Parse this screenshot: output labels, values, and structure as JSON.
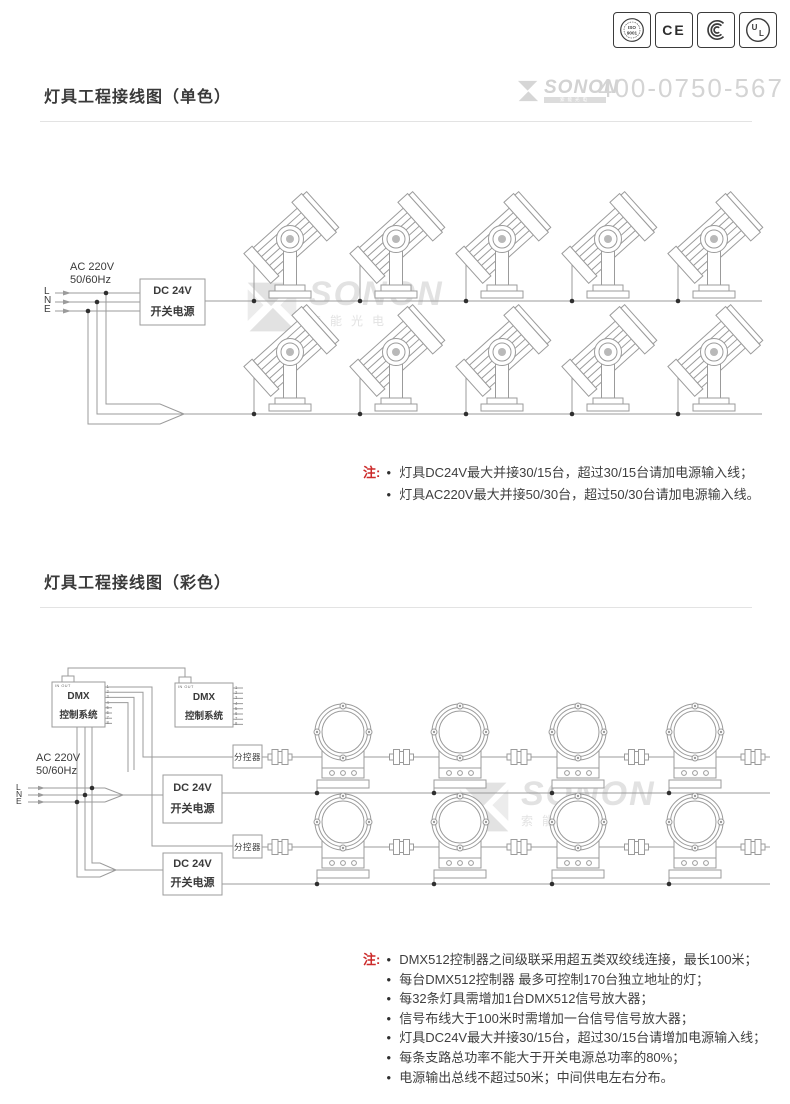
{
  "header": {
    "brand": {
      "name": "SONON",
      "tagline": "索能光电"
    },
    "phone": "400-0750-567",
    "certs": {
      "iso_top": "ISO",
      "iso_bottom": "9001",
      "ce": "CE",
      "ul": "UL"
    }
  },
  "watermark": {
    "name": "SONON",
    "tagline": "索能光电"
  },
  "section1": {
    "title": "灯具工程接线图（单色）",
    "ac": "AC 220V\n50/60Hz",
    "l": "L",
    "n": "N",
    "e": "E",
    "psu1": "DC 24V",
    "psu2": "开关电源",
    "note_label": "注:",
    "notes": [
      "灯具DC24V最大并接30/15台，超过30/15台请加电源输入线；",
      "灯具AC220V最大并接50/30台，超过50/30台请加电源输入线。"
    ]
  },
  "section2": {
    "title": "灯具工程接线图（彩色）",
    "ac": "AC 220V\n50/60Hz",
    "l": "L",
    "n": "N",
    "e": "E",
    "dmx1": "DMX",
    "dmx2": "控制系统",
    "io": "IN OUT",
    "pins": "1\n2\n3\n4\n5\n6\n7\n8",
    "psu1": "DC 24V",
    "psu2": "开关电源",
    "splitter": "分控器",
    "note_label": "注:",
    "notes": [
      "DMX512控制器之间级联采用超五类双绞线连接，最长100米；",
      "每台DMX512控制器 最多可控制170台独立地址的灯；",
      "每32条灯具需增加1台DMX512信号放大器；",
      "信号布线大于100米时需增加一台信号信号放大器；",
      "灯具DC24V最大并接30/15台，超过30/15台请增加电源输入线；",
      "每条支路总功率不能大于开关电源总功率的80%；",
      "电源输出总线不超过50米；中间供电左右分布。"
    ]
  }
}
